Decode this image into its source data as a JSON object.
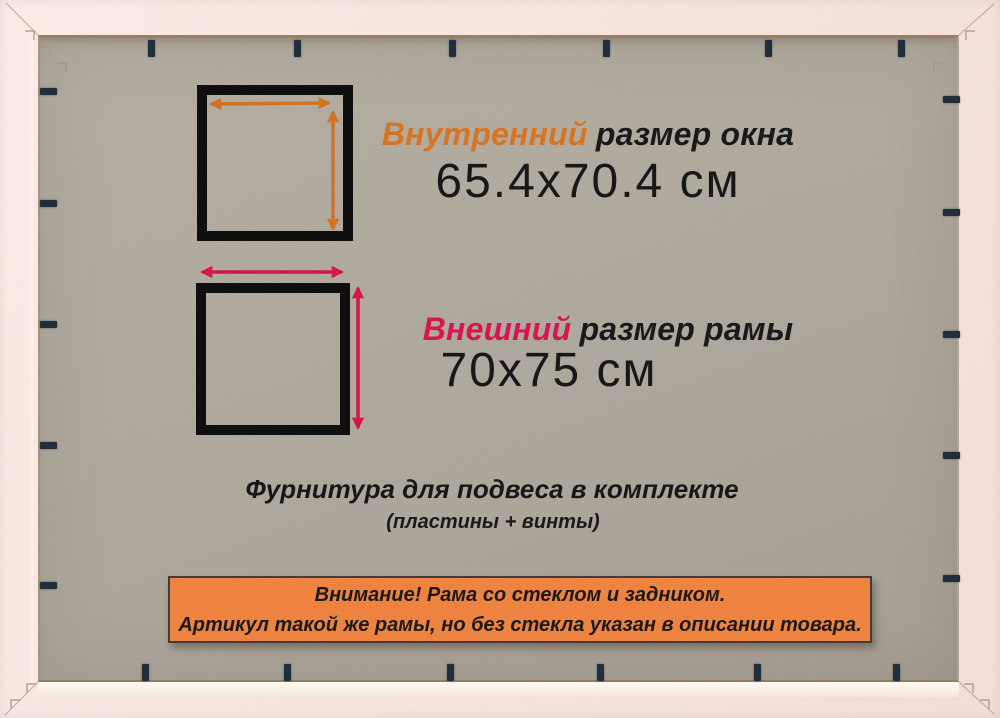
{
  "inner": {
    "highlight": "Внутренний",
    "rest": "размер окна",
    "value": "65.4x70.4 см"
  },
  "outer": {
    "highlight": "Внешний",
    "rest": "размер рамы",
    "value": "70x75 см"
  },
  "hardware": {
    "line1": "Фурнитура для подвеса в комплекте",
    "line2": "(пластины + винты)"
  },
  "notice": {
    "line1": "Внимание! Рама со стеклом и задником.",
    "line2": "Артикул такой же рамы, но без стекла указан в описании товара."
  },
  "colors": {
    "frame_pink": "#f8e6e0",
    "board_gray": "#ada79c",
    "inner_accent": "#d8731e",
    "outer_accent": "#d6134b",
    "notice_bg": "#ef823d",
    "clip_navy": "#1d2a38",
    "text_dark": "#141414",
    "square_border": "#0b0b0b"
  },
  "backing_clips": {
    "top_x": [
      151,
      297,
      452,
      606,
      768,
      901
    ],
    "bottom_x": [
      145,
      287,
      450,
      600,
      757,
      896
    ],
    "left_y": [
      91,
      203,
      324,
      445,
      585
    ],
    "right_y": [
      99,
      212,
      334,
      455,
      578
    ]
  }
}
